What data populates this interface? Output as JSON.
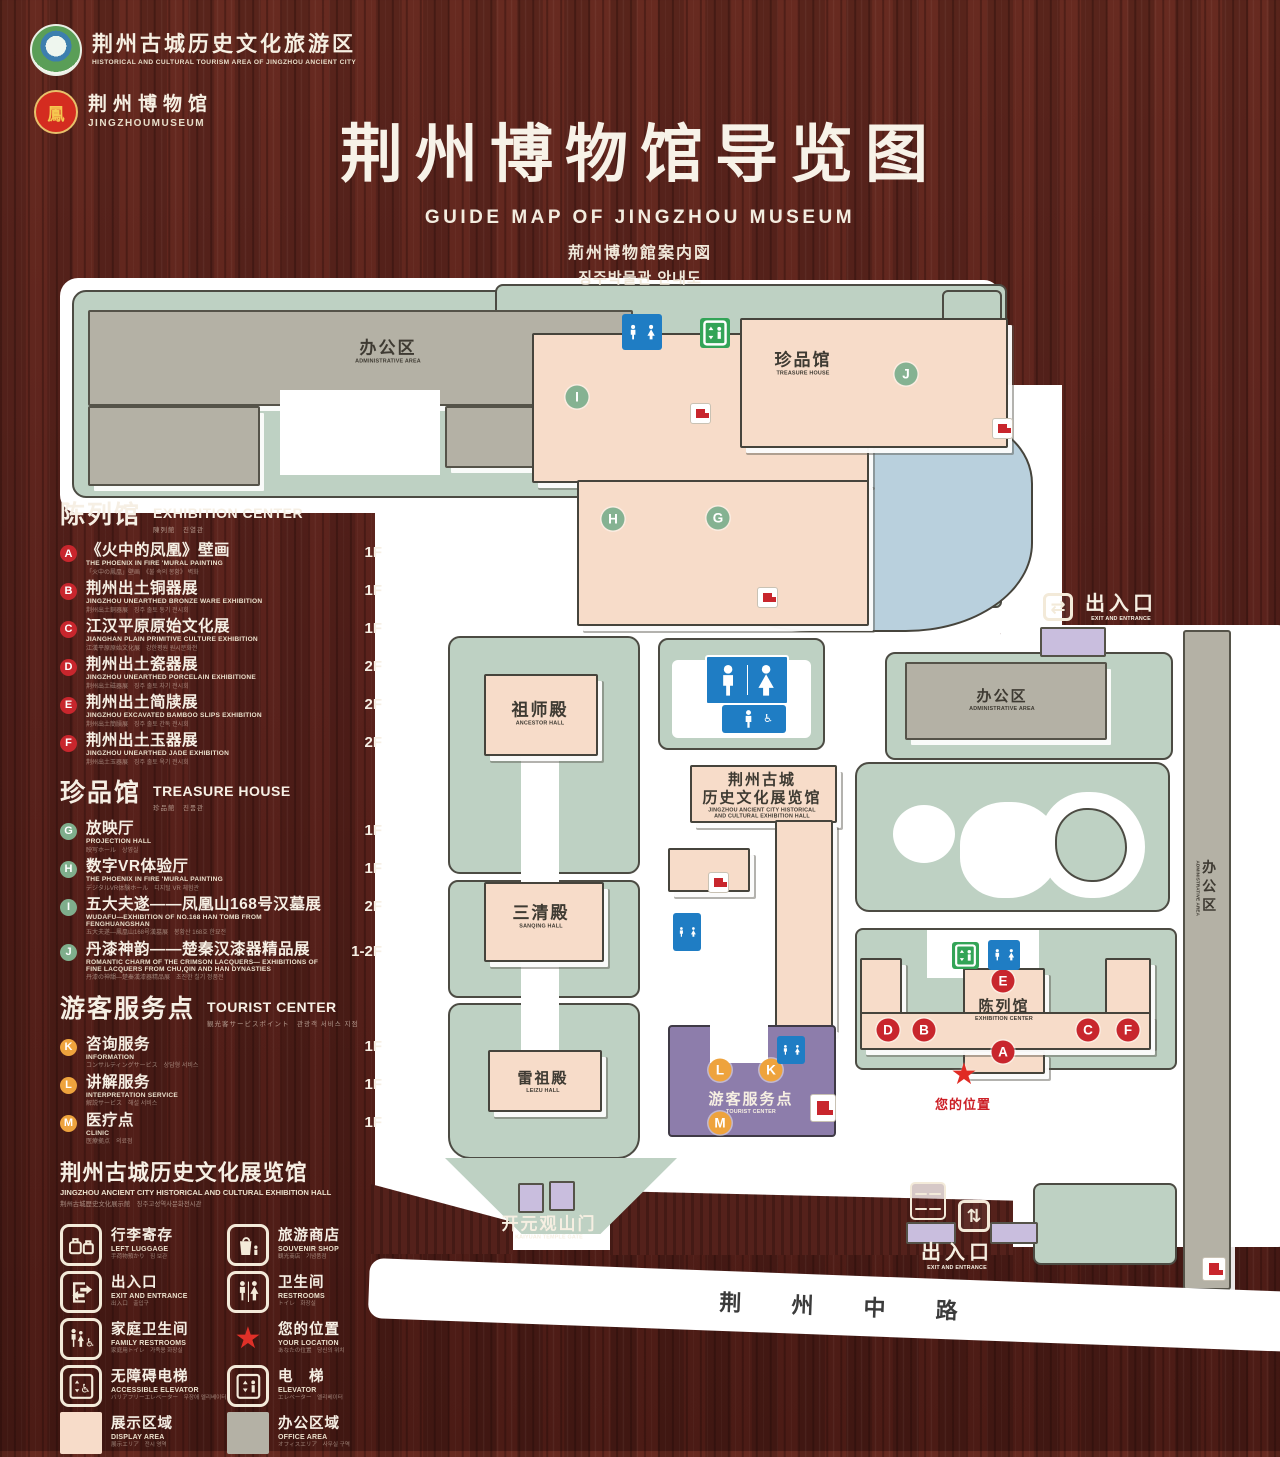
{
  "header": {
    "logo1": {
      "title": "荆州古城历史文化旅游区",
      "subtitle": "HISTORICAL AND CULTURAL TOURISM AREA OF JINGZHOU ANCIENT CITY"
    },
    "logo2": {
      "title": "荆州博物馆",
      "subtitle": "JINGZHOUMUSEUM",
      "glyph": "鳳"
    },
    "title": "荆州博物馆导览图",
    "subtitle_en": "GUIDE MAP OF JINGZHOU MUSEUM",
    "subtitle_ja": "荊州博物館案内図",
    "subtitle_ko": "징주박물관 안내도"
  },
  "sections": [
    {
      "title_zh": "陈列馆",
      "title_en": "EXHIBITION CENTER",
      "title_sub": "陳列館　진열관",
      "color": "red",
      "items": [
        {
          "letter": "A",
          "zh": "《火中的凤凰》壁画",
          "en": "THE PHOENIX IN FIRE 'MURAL PAINTING",
          "sub": "「火中の鳳凰」壁画　《불 속의 봉황》 벽화",
          "floor": "1F"
        },
        {
          "letter": "B",
          "zh": "荆州出土铜器展",
          "en": "JINGZHOU UNEARTHED BRONZE WARE EXHIBITION",
          "sub": "荆州出土銅器展　징주 출토 동기 전시회",
          "floor": "1F"
        },
        {
          "letter": "C",
          "zh": "江汉平原原始文化展",
          "en": "JIANGHAN PLAIN PRIMITIVE CULTURE EXHIBITION",
          "sub": "江漢平原原始文化展　강한평원 원시문화전",
          "floor": "1F"
        },
        {
          "letter": "D",
          "zh": "荆州出土瓷器展",
          "en": "JINGZHOU UNEARTHED PORCELAIN EXHIBITIONE",
          "sub": "荆州出土磁器展　징주 출토 자기 전시회",
          "floor": "2F"
        },
        {
          "letter": "E",
          "zh": "荆州出土简牍展",
          "en": "JINGZHOU EXCAVATED BAMBOO SLIPS EXHIBITION",
          "sub": "荆州出土簡牘展　징주 출토 간독 전시회",
          "floor": "2F"
        },
        {
          "letter": "F",
          "zh": "荆州出土玉器展",
          "en": "JINGZHOU UNEARTHED JADE EXHIBITION",
          "sub": "荆州出土玉器展　징주 출토 옥기 전시회",
          "floor": "2F"
        }
      ]
    },
    {
      "title_zh": "珍品馆",
      "title_en": "TREASURE HOUSE",
      "title_sub": "珍品館　진품관",
      "color": "green",
      "items": [
        {
          "letter": "G",
          "zh": "放映厅",
          "en": "PROJECTION HALL",
          "sub": "映写ホール　상영실",
          "floor": "1F"
        },
        {
          "letter": "H",
          "zh": "数字VR体验厅",
          "en": "THE PHOENIX IN FIRE 'MURAL PAINTING",
          "sub": "デジタルVR体験ホール　디지털 VR 체험관",
          "floor": "1F"
        },
        {
          "letter": "I",
          "zh": "五大夫遂——凤凰山168号汉墓展",
          "en": "WUDAFU—EXHIBITION OF NO.168 HAN TOMB FROM FENGHUANGSHAN",
          "sub": "五大夫遂—鳳凰山168号漢墓展　봉황산 168호 한묘전",
          "floor": "2F"
        },
        {
          "letter": "J",
          "zh": "丹漆神韵——楚秦汉漆器精品展",
          "en": "ROMANTIC CHARM OF THE CRIMSON LACQUERS— EXHIBITIONS OF FINE LACQUERS FROM CHU,QIN AND HAN DYNASTIES",
          "sub": "丹漆の神韻—楚秦漢漆器精品展　초진한 칠기 정품전",
          "floor": "1-2F"
        }
      ]
    },
    {
      "title_zh": "游客服务点",
      "title_en": "TOURIST CENTER",
      "title_sub": "観光客サービスポイント　관광객 서비스 지점",
      "color": "orange",
      "items": [
        {
          "letter": "K",
          "zh": "咨询服务",
          "en": "INFORMATION",
          "sub": "コンサルティングサービス　상담형 서비스",
          "floor": "1F"
        },
        {
          "letter": "L",
          "zh": "讲解服务",
          "en": "INTERPRETATION SERVICE",
          "sub": "解説サービス　해설 서비스",
          "floor": "1F"
        },
        {
          "letter": "M",
          "zh": "医疗点",
          "en": "CLINIC",
          "sub": "医療拠点　의료점",
          "floor": "1F"
        }
      ]
    }
  ],
  "hall_note": {
    "zh": "荆州古城历史文化展览馆",
    "en": "JINGZHOU ANCIENT CITY HISTORICAL AND CULTURAL EXHIBITION HALL",
    "sub": "荆州古城歴史文化展示館　징주고성역사문화전시관"
  },
  "legend_items": [
    {
      "icon": "left-luggage-icon",
      "zh": "行李寄存",
      "en": "LEFT LUGGAGE",
      "sub": "手荷物預かり　짐 보관"
    },
    {
      "icon": "souvenir-shop-icon",
      "zh": "旅游商店",
      "en": "SOUVENIR SHOP",
      "sub": "観光商店　기념품점"
    },
    {
      "icon": "exit-entrance-icon",
      "zh": "出入口",
      "en": "EXIT AND ENTRANCE",
      "sub": "出入口　출입구"
    },
    {
      "icon": "restrooms-icon",
      "zh": "卫生间",
      "en": "RESTROOMS",
      "sub": "トイレ　화장실"
    },
    {
      "icon": "family-restrooms-icon",
      "zh": "家庭卫生间",
      "en": "FAMILY RESTROOMS",
      "sub": "家庭用トイレ　가족용 화장실"
    },
    {
      "icon": "your-location-icon",
      "zh": "您的位置",
      "en": "YOUR LOCATION",
      "sub": "あなたの位置　당신의 위치"
    },
    {
      "icon": "accessible-elevator-icon",
      "zh": "无障碍电梯",
      "en": "ACCESSIBLE ELEVATOR",
      "sub": "バリアフリーエレベーター　무장애 엘리베이터"
    },
    {
      "icon": "elevator-icon",
      "zh": "电　梯",
      "en": "ELEVATOR",
      "sub": "エレベーター　엘리베이터"
    },
    {
      "icon": "display-area-swatch",
      "zh": "展示区域",
      "en": "DISPLAY AREA",
      "sub": "展示エリア　전시 영역"
    },
    {
      "icon": "office-area-swatch",
      "zh": "办公区域",
      "en": "OFFICE AREA",
      "sub": "オフィスエリア　사무실 구역"
    }
  ],
  "map": {
    "admin_nw": {
      "zh": "办公区",
      "en": "ADMINISTRATIVE AREA"
    },
    "treasure": {
      "zh": "珍品馆",
      "en": "TREASURE HOUSE"
    },
    "exit_ne": {
      "zh": "出入口",
      "en": "EXIT AND ENTRANCE"
    },
    "admin_e": {
      "zh": "办公区",
      "en": "ADMINISTRATIVE AREA"
    },
    "admin_strip": {
      "zh": "办公区",
      "en": "ADMINISTRATIVE AREA"
    },
    "ancestor": {
      "zh": "祖师殿",
      "en": "ANCESTOR HALL"
    },
    "sanqing": {
      "zh": "三清殿",
      "en": "SANQING HALL"
    },
    "leizu": {
      "zh": "雷祖殿",
      "en": "LEIZU HALL"
    },
    "history_hall": {
      "zh1": "荆州古城",
      "zh2": "历史文化展览馆",
      "en1": "JINGZHOU ANCIENT CITY HISTORICAL",
      "en2": "AND CULTURAL EXHIBITION HALL"
    },
    "tourist": {
      "zh": "游客服务点",
      "en": "TOURIST CENTER"
    },
    "exhibition": {
      "zh": "陈列馆",
      "en": "EXHIBITION CENTER"
    },
    "your_location": {
      "zh": "您的位置"
    },
    "kaiyuan": {
      "zh": "开元观山门",
      "en": "KAIYUAN TEMPLE GATE"
    },
    "exit_s": {
      "zh": "出入口",
      "en": "EXIT AND ENTRANCE"
    },
    "road": {
      "zh": "荆 州 中 路"
    },
    "markers": [
      {
        "letter": "I",
        "color": "green",
        "x": 522,
        "y": 127
      },
      {
        "letter": "H",
        "color": "green",
        "x": 558,
        "y": 249
      },
      {
        "letter": "G",
        "color": "green",
        "x": 663,
        "y": 248
      },
      {
        "letter": "J",
        "color": "green",
        "x": 851,
        "y": 104
      },
      {
        "letter": "E",
        "color": "red",
        "x": 948,
        "y": 711
      },
      {
        "letter": "D",
        "color": "red",
        "x": 833,
        "y": 760
      },
      {
        "letter": "B",
        "color": "red",
        "x": 869,
        "y": 760
      },
      {
        "letter": "A",
        "color": "red",
        "x": 948,
        "y": 782
      },
      {
        "letter": "C",
        "color": "red",
        "x": 1033,
        "y": 760
      },
      {
        "letter": "F",
        "color": "red",
        "x": 1073,
        "y": 760
      },
      {
        "letter": "L",
        "color": "orange",
        "x": 665,
        "y": 800
      },
      {
        "letter": "K",
        "color": "orange",
        "x": 716,
        "y": 800
      },
      {
        "letter": "M",
        "color": "orange",
        "x": 665,
        "y": 853
      }
    ]
  }
}
